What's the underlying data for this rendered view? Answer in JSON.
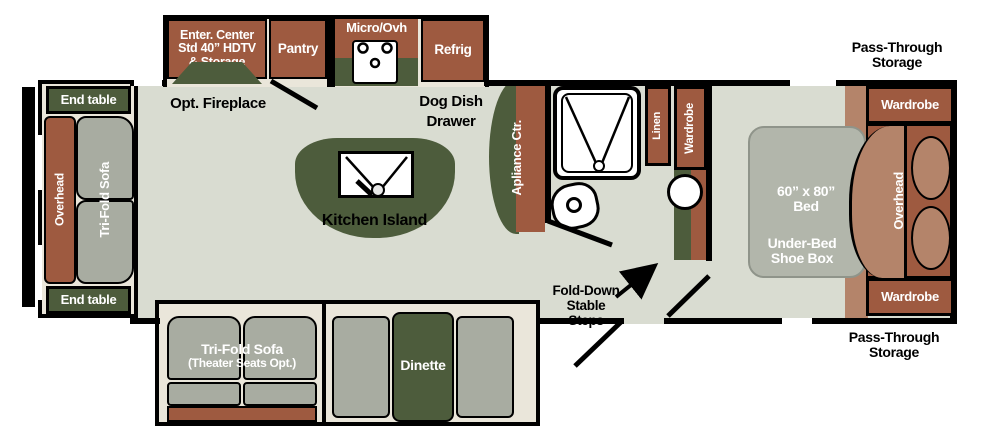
{
  "title": "Fifth-wheel RV floor plan",
  "colors": {
    "cabinet_brown": "#9e5a40",
    "light_brown": "#b4846a",
    "counter_green": "#4d5c3c",
    "floor_gray_green": "#d9dcd1",
    "cushion_gray": "#a8aca1",
    "slide_cream": "#eae6da",
    "outline_black": "#000000",
    "label_white": "#ffffff"
  },
  "left_slide": {
    "end_table_top": "End table",
    "end_table_bottom": "End table",
    "overhead": "Overhead",
    "sofa": "Tri-Fold Sofa"
  },
  "top_row": {
    "enter_center": {
      "lines": [
        "Enter. Center",
        "Std 40” HDTV",
        "& Storage"
      ]
    },
    "pantry": "Pantry",
    "micro": "Micro/Ovh",
    "refrig": "Refrig",
    "opt_fireplace": "Opt. Fireplace",
    "dog_dish": {
      "lines": [
        "Dog Dish",
        "Drawer"
      ]
    }
  },
  "kitchen": {
    "island": "Kitchen Island",
    "appliance_ctr": "Apliance Ctr."
  },
  "bathroom": {
    "linen": "Linen",
    "wardrobe": "Wardrobe"
  },
  "entry": {
    "steps": {
      "lines": [
        "Fold-Down",
        "Stable",
        "Steps"
      ]
    }
  },
  "bedroom": {
    "bed_size": {
      "lines": [
        "60” x 80”",
        "Bed"
      ]
    },
    "under_bed": {
      "lines": [
        "Under-Bed",
        "Shoe Box"
      ]
    },
    "overhead": "Overhead",
    "wardrobe_top": "Wardrobe",
    "wardrobe_bottom": "Wardrobe"
  },
  "storage": {
    "top": {
      "lines": [
        "Pass-Through",
        "Storage"
      ]
    },
    "bottom": {
      "lines": [
        "Pass-Through",
        "Storage"
      ]
    }
  },
  "bottom_slide": {
    "sofa": {
      "lines": [
        "Tri-Fold Sofa",
        "(Theater Seats Opt.)"
      ]
    },
    "dinette": "Dinette"
  }
}
